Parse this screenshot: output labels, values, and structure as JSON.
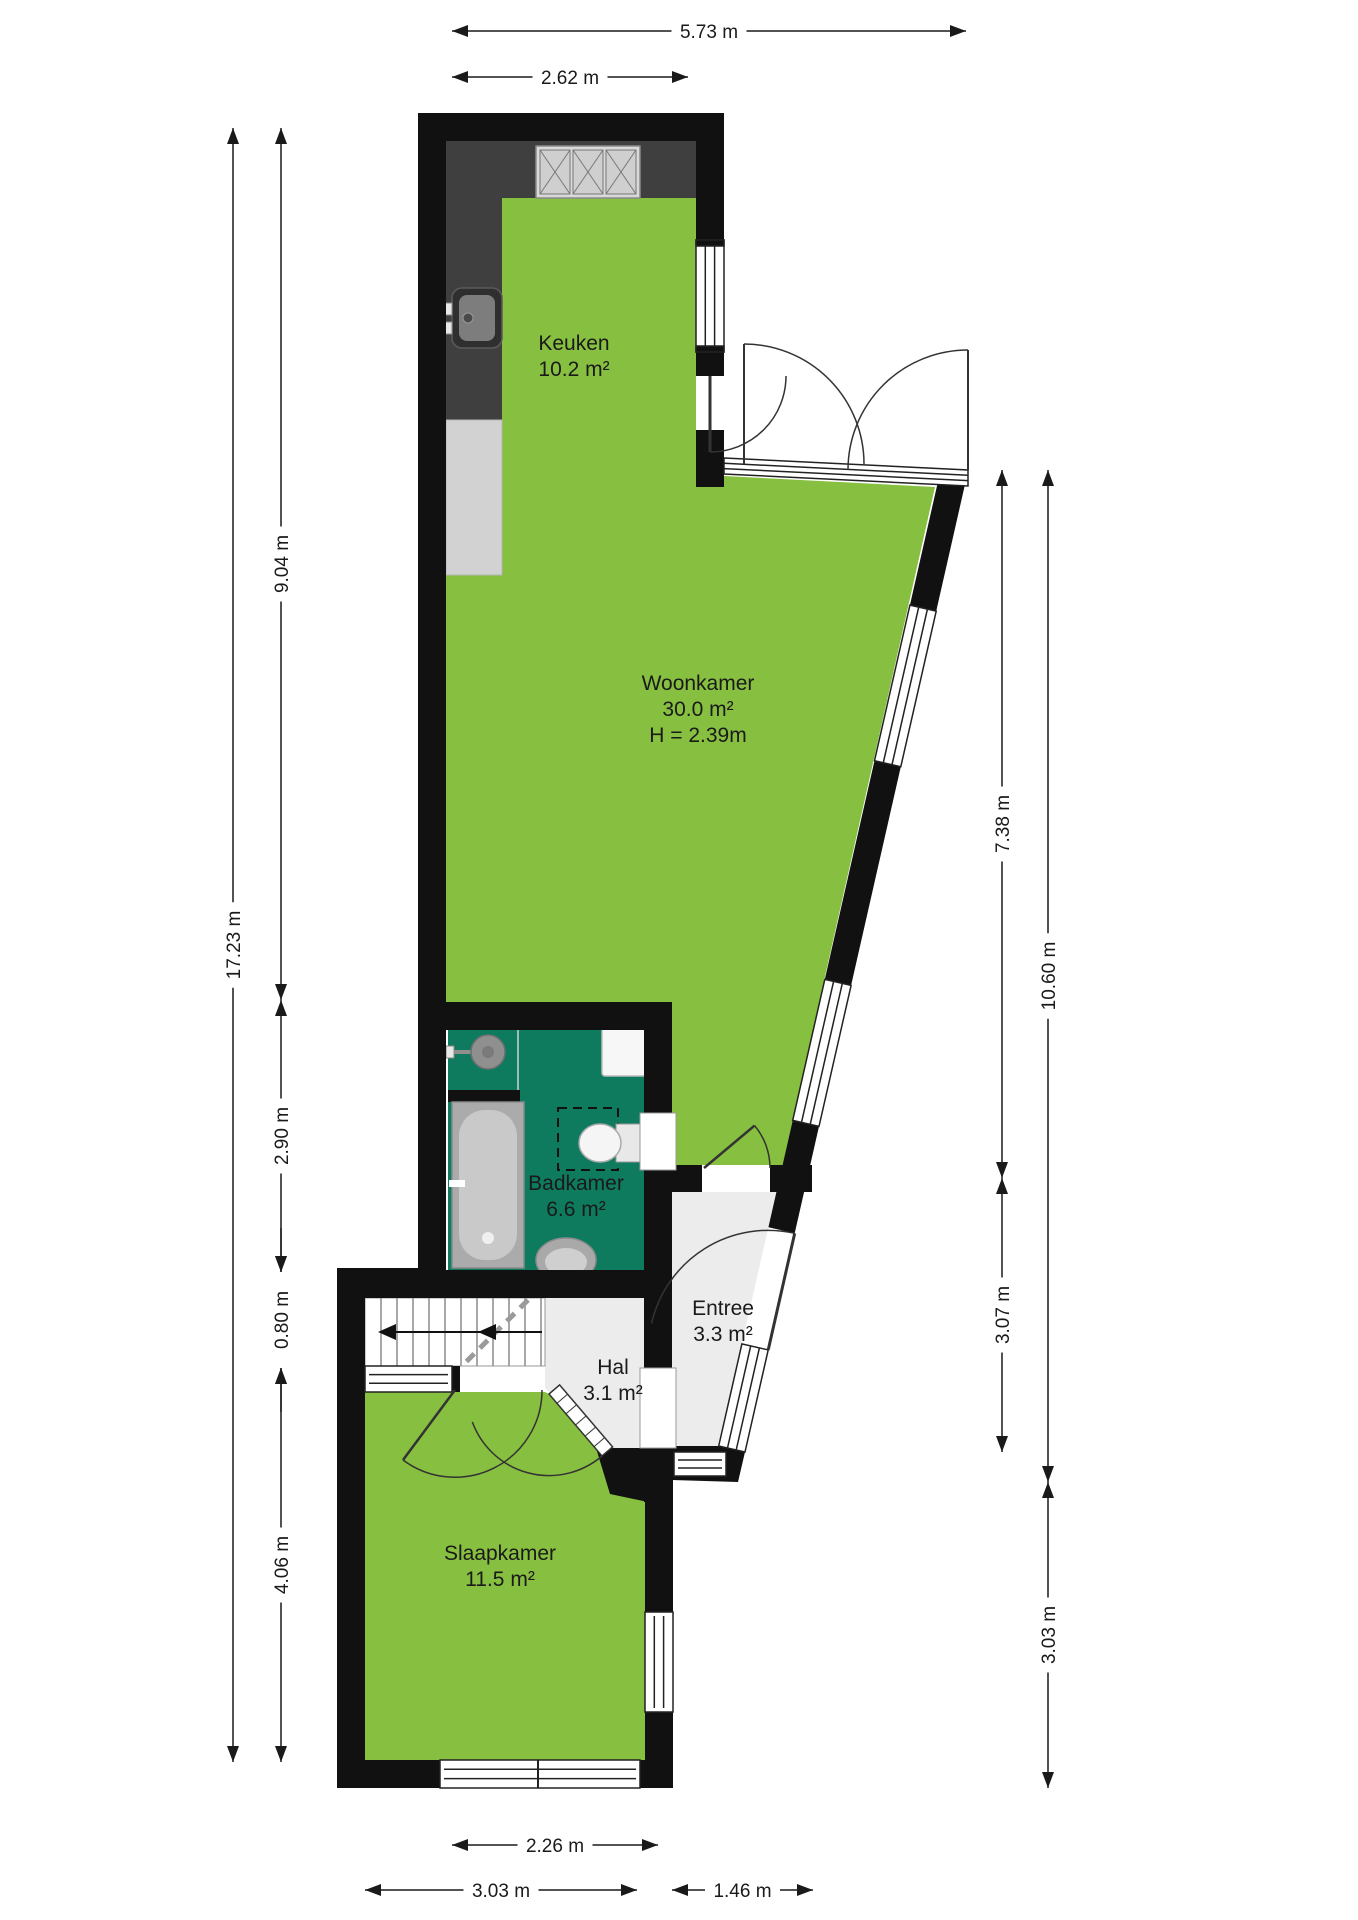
{
  "title": "Floor plan (begane grond)",
  "colors": {
    "wall": "#111111",
    "room_green": "#87bf40",
    "bathroom_teal": "#0e7a5e",
    "hall_gray": "#ececec",
    "counter_dark": "#3f3f3f",
    "dim_line": "#1a1a1a"
  },
  "rooms": [
    {
      "id": "keuken",
      "name": "Keuken",
      "area": "10.2 m²",
      "label_x": 574,
      "label_y": 350
    },
    {
      "id": "woonkamer",
      "name": "Woonkamer",
      "area": "30.0 m²",
      "height_note": "H = 2.39m",
      "label_x": 698,
      "label_y": 690
    },
    {
      "id": "badkamer",
      "name": "Badkamer",
      "area": "6.6 m²",
      "label_x": 576,
      "label_y": 1190
    },
    {
      "id": "entree",
      "name": "Entree",
      "area": "3.3 m²",
      "label_x": 723,
      "label_y": 1315
    },
    {
      "id": "hal",
      "name": "Hal",
      "area": "3.1 m²",
      "label_x": 613,
      "label_y": 1374
    },
    {
      "id": "slaapkamer",
      "name": "Slaapkamer",
      "area": "11.5 m²",
      "label_x": 500,
      "label_y": 1560
    }
  ],
  "dimensions": {
    "top": [
      {
        "label": "5.73 m",
        "x1": 452,
        "x2": 966,
        "y": 31
      },
      {
        "label": "2.62 m",
        "x1": 452,
        "x2": 688,
        "y": 77
      }
    ],
    "left": [
      {
        "label": "17.23 m",
        "x": 233,
        "y1": 128,
        "y2": 1762
      },
      {
        "label": "9.04 m",
        "x": 281,
        "y1": 128,
        "y2": 1000
      },
      {
        "label": "2.90 m",
        "x": 281,
        "y1": 1000,
        "y2": 1272
      },
      {
        "label": "0.80 m",
        "x": 281,
        "y1": 1272,
        "y2": 1368,
        "arrows": "outside"
      },
      {
        "label": "4.06 m",
        "x": 281,
        "y1": 1368,
        "y2": 1762
      }
    ],
    "right": [
      {
        "label": "7.38 m",
        "x": 1002,
        "y1": 470,
        "y2": 1178
      },
      {
        "label": "3.07 m",
        "x": 1002,
        "y1": 1178,
        "y2": 1452
      },
      {
        "label": "10.60 m",
        "x": 1048,
        "y1": 470,
        "y2": 1482
      },
      {
        "label": "3.03 m",
        "x": 1048,
        "y1": 1482,
        "y2": 1788
      }
    ],
    "bottom": [
      {
        "label": "2.26 m",
        "x1": 452,
        "x2": 658,
        "y": 1845
      },
      {
        "label": "3.03 m",
        "x1": 365,
        "x2": 637,
        "y": 1890
      },
      {
        "label": "1.46 m",
        "x1": 672,
        "x2": 813,
        "y": 1890
      }
    ]
  },
  "fixtures": [
    "stove-icon",
    "kitchen-sink-icon",
    "kitchen-counter",
    "washbasin-icon",
    "boiler-icon",
    "bathtub-icon",
    "shower-icon",
    "toilet-icon",
    "oval-sink-icon",
    "stairs",
    "door-swing",
    "window"
  ]
}
